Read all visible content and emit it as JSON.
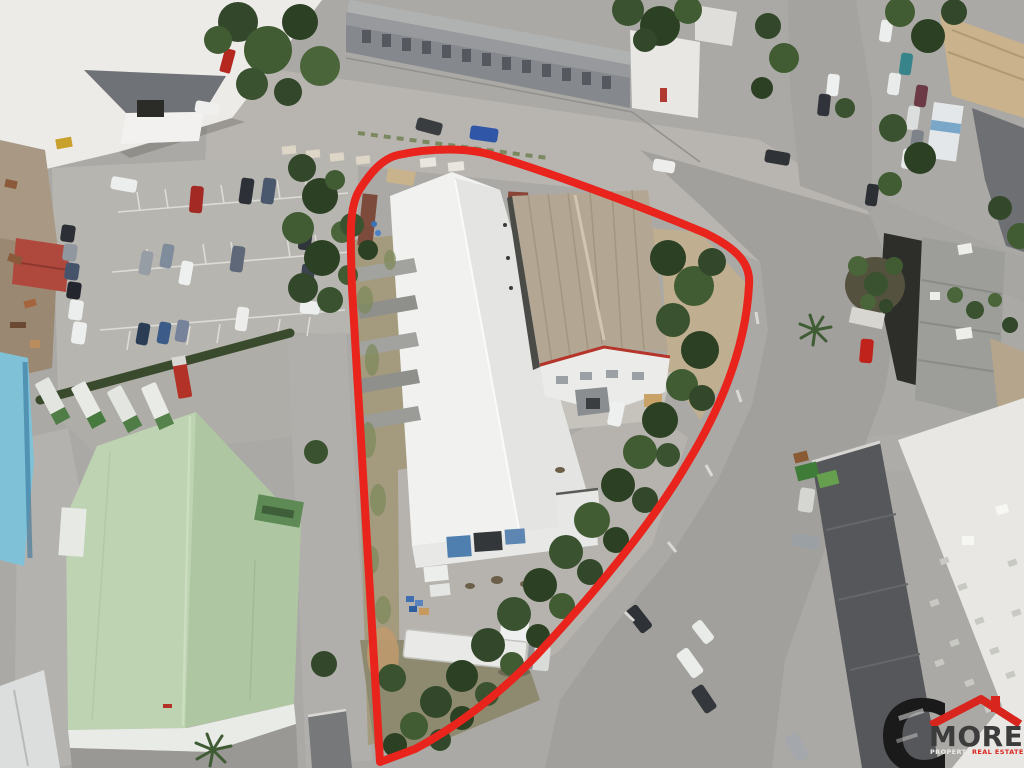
{
  "watermark": {
    "monogram": "C",
    "brand": "MORE",
    "tagline_left": "PROPERTIES",
    "tagline_right": "REAL ESTATES",
    "colors": {
      "monogram": "#1a1a1a",
      "roof": "#d8261f",
      "brand": "#3c3c3c",
      "tagline_left": "#ecebe7",
      "tagline_right": "#d8261f"
    }
  },
  "annotation": {
    "property_outline_color": "#e8241d"
  }
}
